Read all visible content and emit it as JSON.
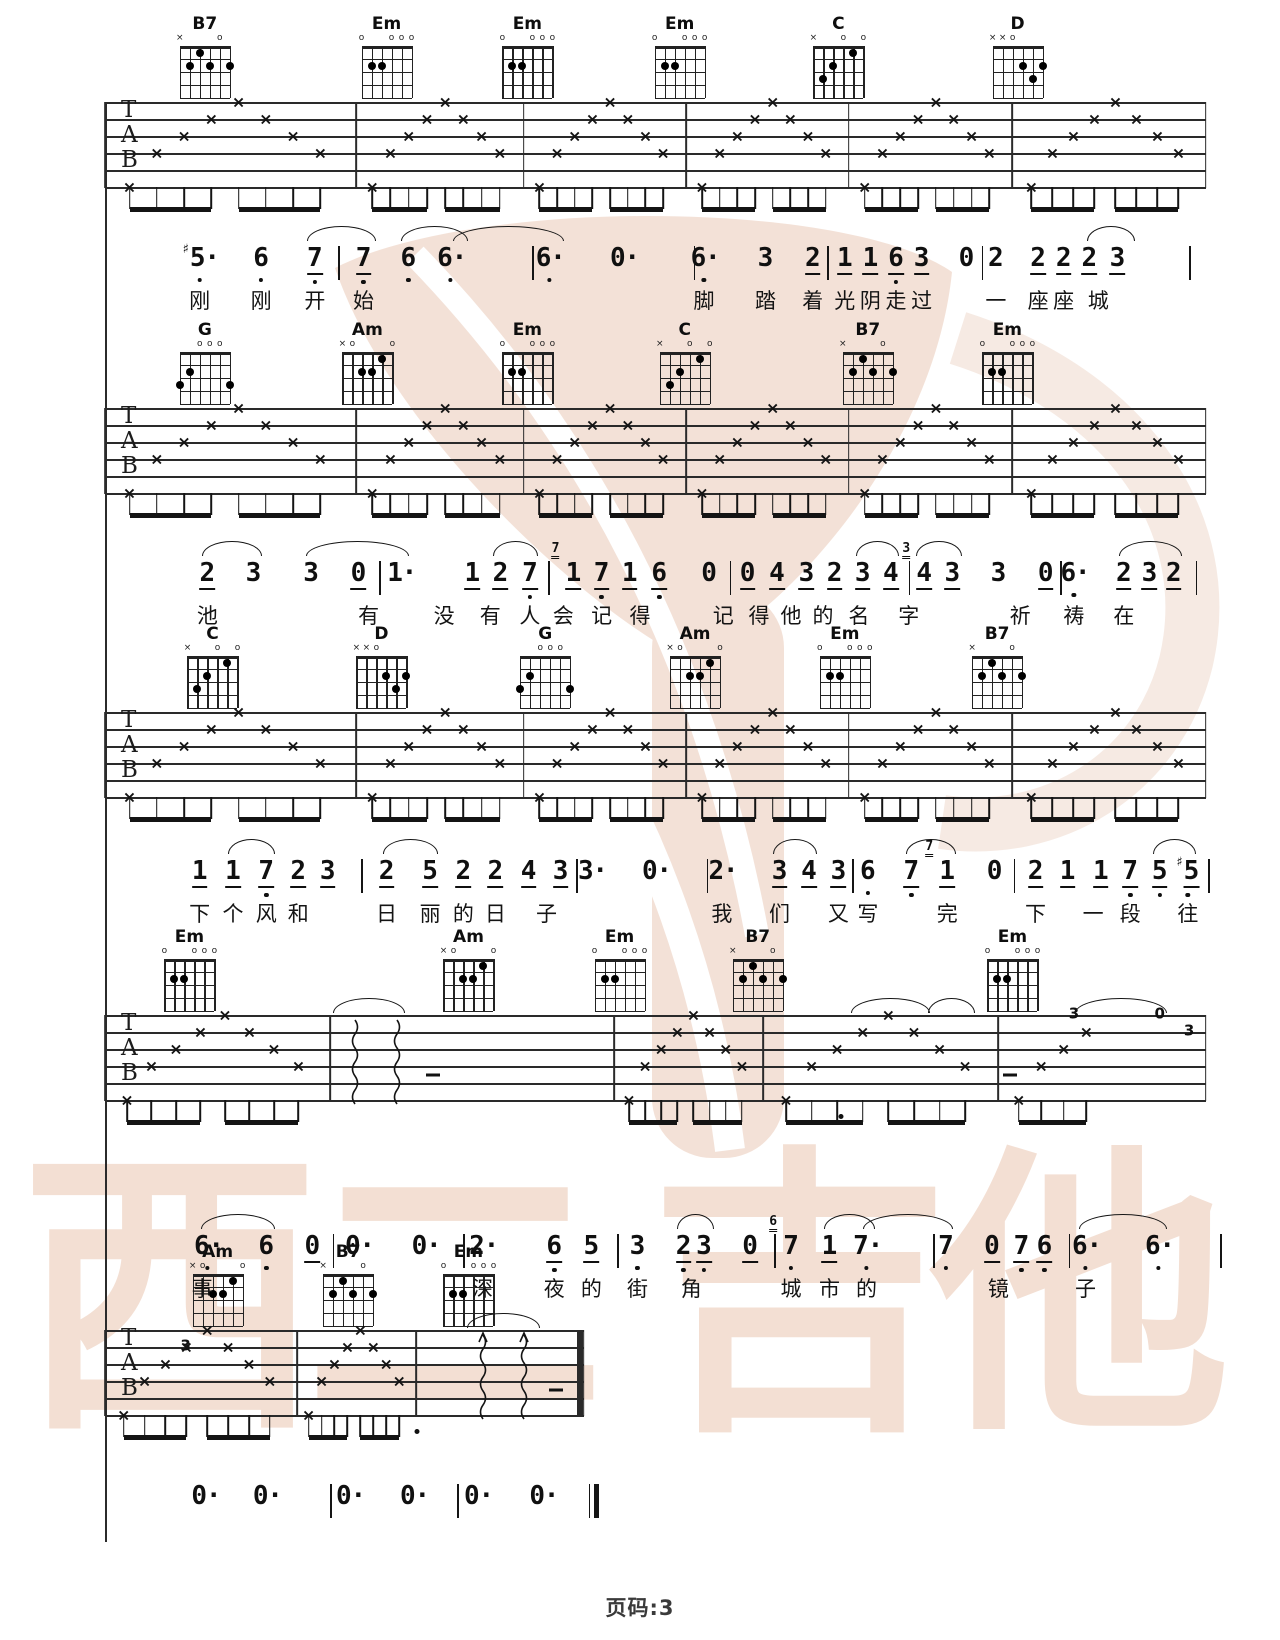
{
  "page": {
    "number_label": "页码:3",
    "paper_color": "#ffffff",
    "ink_color": "#141414"
  },
  "watermark": {
    "chars": [
      "西",
      "二",
      "吉",
      "他"
    ],
    "char_x": [
      170,
      455,
      800,
      1080
    ],
    "text_color": "rgba(224,170,140,0.38)",
    "logo_color": "#e9c5b1",
    "ring_color": "#eed6c8",
    "stripe_color": "#ffffff"
  },
  "strum_pattern": [
    6,
    4,
    3,
    2,
    1,
    2,
    3,
    4
  ],
  "chord_shapes": {
    "B7": {
      "markers": [
        "x",
        "",
        "",
        "",
        "o",
        ""
      ],
      "dots": [
        [
          5,
          2
        ],
        [
          4,
          1
        ],
        [
          3,
          2
        ],
        [
          1,
          2
        ]
      ]
    },
    "Em": {
      "markers": [
        "o",
        "",
        "",
        "o",
        "o",
        "o"
      ],
      "dots": [
        [
          5,
          2
        ],
        [
          4,
          2
        ]
      ]
    },
    "C": {
      "markers": [
        "x",
        "",
        "",
        "o",
        "",
        "o"
      ],
      "dots": [
        [
          5,
          3
        ],
        [
          4,
          2
        ],
        [
          2,
          1
        ]
      ]
    },
    "D": {
      "markers": [
        "x",
        "x",
        "o",
        "",
        "",
        ""
      ],
      "dots": [
        [
          3,
          2
        ],
        [
          2,
          3
        ],
        [
          1,
          2
        ]
      ]
    },
    "G": {
      "markers": [
        "",
        "",
        "o",
        "o",
        "o",
        ""
      ],
      "dots": [
        [
          6,
          3
        ],
        [
          5,
          2
        ],
        [
          1,
          3
        ]
      ]
    },
    "Am": {
      "markers": [
        "x",
        "o",
        "",
        "",
        "",
        "o"
      ],
      "dots": [
        [
          4,
          2
        ],
        [
          3,
          2
        ],
        [
          2,
          1
        ]
      ]
    }
  },
  "systems": [
    {
      "top": 102,
      "left": 8.2,
      "right": 94.2,
      "bars": [
        27.8,
        40.9,
        53.6,
        66.3,
        79.1
      ],
      "chords": [
        [
          "B7",
          16
        ],
        [
          "Em",
          30.2
        ],
        [
          "Em",
          41.2
        ],
        [
          "Em",
          53.1
        ],
        [
          "C",
          65.5
        ],
        [
          "D",
          79.5
        ]
      ]
    },
    {
      "top": 408,
      "left": 8.2,
      "right": 94.2,
      "bars": [
        27.8,
        40.9,
        53.6,
        66.3,
        79.1
      ],
      "chords": [
        [
          "G",
          16
        ],
        [
          "Am",
          28.7
        ],
        [
          "Em",
          41.2
        ],
        [
          "C",
          53.5
        ],
        [
          "B7",
          67.8
        ],
        [
          "Em",
          78.7
        ]
      ]
    },
    {
      "top": 712,
      "left": 8.2,
      "right": 94.2,
      "bars": [
        27.8,
        40.9,
        53.6,
        66.3,
        79.1
      ],
      "chords": [
        [
          "C",
          16.6
        ],
        [
          "D",
          29.8
        ],
        [
          "G",
          42.6
        ],
        [
          "Am",
          54.3
        ],
        [
          "Em",
          66
        ],
        [
          "B7",
          77.9
        ]
      ]
    },
    {
      "top": 1015,
      "left": 8.2,
      "right": 94.2,
      "bars": [
        25.8,
        48,
        59.6,
        78
      ],
      "chords": [
        [
          "Em",
          14.8
        ],
        [
          "Am",
          36.6
        ],
        [
          "Em",
          48.4
        ],
        [
          "B7",
          59.2
        ],
        [
          "Em",
          79.1
        ]
      ],
      "wavy": {
        "measure": 1,
        "xs": [
          27.7,
          31.0
        ],
        "arrow": false
      },
      "dashes": [
        {
          "x": 33.8,
          "line": 3.5
        },
        {
          "x": 78.9,
          "line": 3.5
        }
      ],
      "nums": [
        {
          "t": "3",
          "x": 83.9,
          "line": 1
        },
        {
          "t": "0",
          "x": 90.6,
          "line": 1
        },
        {
          "t": "3",
          "x": 92.9,
          "line": 2
        }
      ],
      "half_measure": 4,
      "dots_below": [
        {
          "x": 65.7
        }
      ],
      "arcs": [
        [
          26,
          31.5
        ],
        [
          66.5,
          72.5
        ],
        [
          72.5,
          76
        ],
        [
          84,
          91
        ]
      ]
    },
    {
      "top": 1330,
      "left": 8.2,
      "right": 45.6,
      "bars": [
        23.2,
        32.5
      ],
      "chords": [
        [
          "Am",
          17
        ],
        [
          "B7",
          27.2
        ],
        [
          "Em",
          36.6
        ]
      ],
      "wavy": {
        "measure": 2,
        "xs": [
          37.7,
          40.9
        ],
        "arrow": true
      },
      "dashes": [
        {
          "x": 43.4,
          "line": 3.5
        }
      ],
      "nums": [
        {
          "t": "3",
          "x": 14.5,
          "line": 2
        }
      ],
      "final": true,
      "dots_below": [
        {
          "x": 32.6
        }
      ],
      "arcs": [
        [
          36.5,
          42
        ]
      ]
    }
  ],
  "flag_legend": "#=sharp d=dot-after l=low-octave-dot u=underline | 4th item = grace note digit",
  "jianpu_lines": [
    {
      "y": 270,
      "tokens": [
        [
          15.6,
          "5",
          "#dl"
        ],
        [
          20.4,
          "6",
          "l"
        ],
        [
          24.6,
          "7",
          "lu"
        ],
        [
          26.4,
          "|"
        ],
        [
          28.4,
          "7",
          "lu"
        ],
        [
          31.9,
          "6",
          "l"
        ],
        [
          35.2,
          "6",
          "dl"
        ],
        [
          41.6,
          "|"
        ],
        [
          42.9,
          "6",
          "dl"
        ],
        [
          48.7,
          "0",
          "d"
        ],
        [
          54.2,
          "|"
        ],
        [
          55,
          "6",
          "dl"
        ],
        [
          59.8,
          "3",
          ""
        ],
        [
          63.5,
          "2",
          "u"
        ],
        [
          64.6,
          "|"
        ],
        [
          66,
          "1",
          "u"
        ],
        [
          68,
          "1",
          "u"
        ],
        [
          70,
          "6",
          "lu"
        ],
        [
          72,
          "3",
          "u"
        ],
        [
          75.5,
          "0",
          ""
        ],
        [
          76.7,
          "|"
        ],
        [
          77.8,
          "2",
          ""
        ],
        [
          81.1,
          "2",
          "u"
        ],
        [
          83.1,
          "2",
          "u"
        ],
        [
          85.1,
          "2",
          "u"
        ],
        [
          87.3,
          "3",
          "u"
        ],
        [
          92.9,
          "|"
        ]
      ],
      "arcs": [
        [
          24,
          29.2
        ],
        [
          31.3,
          36.4
        ],
        [
          35.4,
          43.9
        ],
        [
          84.9,
          88.5
        ]
      ],
      "lyrics": [
        [
          15.6,
          "刚"
        ],
        [
          20.4,
          "刚"
        ],
        [
          24.6,
          "开"
        ],
        [
          28.4,
          "始"
        ],
        [
          55,
          "脚"
        ],
        [
          59.8,
          "踏"
        ],
        [
          63.5,
          "着"
        ],
        [
          66,
          "光"
        ],
        [
          68,
          "阴"
        ],
        [
          70,
          "走"
        ],
        [
          72,
          "过"
        ],
        [
          77.8,
          "一"
        ],
        [
          81.1,
          "座"
        ],
        [
          83.1,
          "座"
        ],
        [
          85.8,
          "城"
        ]
      ]
    },
    {
      "y": 585,
      "tokens": [
        [
          16.2,
          "2",
          "u"
        ],
        [
          19.8,
          "3",
          ""
        ],
        [
          24.3,
          "3",
          ""
        ],
        [
          28,
          "0",
          "u"
        ],
        [
          29.6,
          "|"
        ],
        [
          31.3,
          "1",
          "d"
        ],
        [
          36.9,
          "1",
          "u"
        ],
        [
          39.1,
          "2",
          "u"
        ],
        [
          41.4,
          "7",
          "lu"
        ],
        [
          42.8,
          "|"
        ],
        [
          44.8,
          "1",
          "u",
          "7"
        ],
        [
          47,
          "7",
          "lu"
        ],
        [
          49.2,
          "1",
          "u"
        ],
        [
          51.5,
          "6",
          "lu"
        ],
        [
          55.4,
          "0",
          ""
        ],
        [
          57,
          "|"
        ],
        [
          58.4,
          "0",
          "u"
        ],
        [
          60.7,
          "4",
          "u"
        ],
        [
          63,
          "3",
          "u"
        ],
        [
          65.2,
          "2",
          "u"
        ],
        [
          67.4,
          "3",
          "u"
        ],
        [
          69.6,
          "4",
          "u"
        ],
        [
          71,
          "|"
        ],
        [
          72.2,
          "4",
          "u",
          "3"
        ],
        [
          74.4,
          "3",
          "u"
        ],
        [
          78,
          "3",
          ""
        ],
        [
          81.7,
          "0",
          "u"
        ],
        [
          82.8,
          "|"
        ],
        [
          83.9,
          "6",
          "dl"
        ],
        [
          87.8,
          "2",
          "u"
        ],
        [
          89.8,
          "3",
          "u"
        ],
        [
          91.7,
          "2",
          "u"
        ],
        [
          93.4,
          "|"
        ]
      ],
      "arcs": [
        [
          15.8,
          20.3
        ],
        [
          23.9,
          31.8
        ],
        [
          38.5,
          41.9
        ],
        [
          66.9,
          70.1
        ],
        [
          71.6,
          75
        ],
        [
          87.4,
          92.2
        ]
      ],
      "lyrics": [
        [
          16.2,
          "池"
        ],
        [
          28.8,
          "有"
        ],
        [
          34.7,
          "没"
        ],
        [
          38.3,
          "有"
        ],
        [
          41.4,
          "人"
        ],
        [
          44,
          "会"
        ],
        [
          47,
          "记"
        ],
        [
          50,
          "得"
        ],
        [
          56.5,
          "记"
        ],
        [
          59.3,
          "得"
        ],
        [
          61.8,
          "他"
        ],
        [
          64.3,
          "的"
        ],
        [
          67.1,
          "名"
        ],
        [
          71,
          "字"
        ],
        [
          79.7,
          "祈"
        ],
        [
          83.9,
          "祷"
        ],
        [
          87.8,
          "在"
        ]
      ]
    },
    {
      "y": 883,
      "tokens": [
        [
          15.6,
          "1",
          "u"
        ],
        [
          18.2,
          "1",
          "u"
        ],
        [
          20.8,
          "7",
          "lu"
        ],
        [
          23.3,
          "2",
          "u"
        ],
        [
          25.6,
          "3",
          "u"
        ],
        [
          28.2,
          "|"
        ],
        [
          30.2,
          "2",
          "u"
        ],
        [
          33.6,
          "5",
          "u"
        ],
        [
          36.2,
          "2",
          "u"
        ],
        [
          38.7,
          "2",
          "u"
        ],
        [
          41.3,
          "4",
          "u"
        ],
        [
          43.8,
          "3",
          "u"
        ],
        [
          45,
          "|"
        ],
        [
          46.2,
          "3",
          "d"
        ],
        [
          51.2,
          "0",
          "d"
        ],
        [
          55.2,
          "|"
        ],
        [
          56.4,
          "2",
          "d"
        ],
        [
          60.9,
          "3",
          "u"
        ],
        [
          63.2,
          "4",
          "u"
        ],
        [
          65.5,
          "3",
          "u"
        ],
        [
          66.6,
          "|"
        ],
        [
          67.8,
          "6",
          "l"
        ],
        [
          71.2,
          "7",
          "lu"
        ],
        [
          74,
          "1",
          "u",
          "7"
        ],
        [
          77.7,
          "0",
          ""
        ],
        [
          79.2,
          "|"
        ],
        [
          80.9,
          "2",
          "u"
        ],
        [
          83.4,
          "1",
          "u"
        ],
        [
          86,
          "1",
          "u"
        ],
        [
          88.3,
          "7",
          "lu"
        ],
        [
          90.6,
          "5",
          "lu"
        ],
        [
          92.8,
          "5",
          "#lu"
        ],
        [
          94.4,
          "|"
        ]
      ],
      "arcs": [
        [
          17.8,
          21.3
        ],
        [
          29.9,
          34.1
        ],
        [
          60.4,
          63.7
        ],
        [
          70.8,
          74.5
        ],
        [
          90.1,
          93.3
        ]
      ],
      "lyrics": [
        [
          15.6,
          "下"
        ],
        [
          18.2,
          "个"
        ],
        [
          20.8,
          "风"
        ],
        [
          23.3,
          "和"
        ],
        [
          30.2,
          "日"
        ],
        [
          33.6,
          "丽"
        ],
        [
          36.2,
          "的"
        ],
        [
          38.7,
          "日"
        ],
        [
          42.7,
          "子"
        ],
        [
          56.4,
          "我"
        ],
        [
          60.9,
          "们"
        ],
        [
          65.5,
          "又"
        ],
        [
          67.8,
          "写"
        ],
        [
          74,
          "完"
        ],
        [
          80.9,
          "下"
        ],
        [
          85.4,
          "一"
        ],
        [
          88.3,
          "段"
        ],
        [
          92.8,
          "往"
        ]
      ]
    },
    {
      "y": 1258,
      "tokens": [
        [
          16.2,
          "6",
          "dl"
        ],
        [
          20.8,
          "6",
          "l"
        ],
        [
          24.4,
          "0",
          "u"
        ],
        [
          26,
          "|"
        ],
        [
          28,
          "0",
          "d"
        ],
        [
          33.2,
          "0",
          "d"
        ],
        [
          36.2,
          "|"
        ],
        [
          37.7,
          "2",
          "d"
        ],
        [
          43.3,
          "6",
          "lu"
        ],
        [
          46.2,
          "5",
          "u"
        ],
        [
          48.2,
          "|"
        ],
        [
          49.8,
          "3",
          "l"
        ],
        [
          53.4,
          "2",
          "lu"
        ],
        [
          55,
          "3",
          "lu"
        ],
        [
          58.6,
          "0",
          "u"
        ],
        [
          60.5,
          "|"
        ],
        [
          61.8,
          "7",
          "l",
          "6"
        ],
        [
          64.8,
          "1",
          "u"
        ],
        [
          67.7,
          "7",
          "dl"
        ],
        [
          72.9,
          "|"
        ],
        [
          73.9,
          "7",
          "l"
        ],
        [
          77.5,
          "0",
          "u"
        ],
        [
          79.8,
          "7",
          "lu"
        ],
        [
          81.6,
          "6",
          "lu"
        ],
        [
          83.5,
          "|"
        ],
        [
          84.8,
          "6",
          "dl"
        ],
        [
          90.5,
          "6",
          "dl"
        ],
        [
          95.3,
          "|"
        ]
      ],
      "arcs": [
        [
          15.7,
          21.3
        ],
        [
          52.9,
          55.6
        ],
        [
          64.4,
          68.2
        ],
        [
          67.4,
          74.3
        ],
        [
          84.3,
          91
        ]
      ],
      "lyrics": [
        [
          15.8,
          "事"
        ],
        [
          37.7,
          "深"
        ],
        [
          43.3,
          "夜"
        ],
        [
          46.2,
          "的"
        ],
        [
          49.8,
          "街"
        ],
        [
          54,
          "角"
        ],
        [
          61.8,
          "城"
        ],
        [
          64.8,
          "市"
        ],
        [
          67.7,
          "的"
        ],
        [
          78,
          "镜"
        ],
        [
          84.8,
          "子"
        ]
      ]
    },
    {
      "y": 1508,
      "tokens": [
        [
          16,
          "0",
          "d"
        ],
        [
          20.8,
          "0",
          "d"
        ],
        [
          25.8,
          "|"
        ],
        [
          27.3,
          "0",
          "d"
        ],
        [
          32.3,
          "0",
          "d"
        ],
        [
          35.7,
          "|"
        ],
        [
          37.3,
          "0",
          "d"
        ],
        [
          42.4,
          "0",
          "d"
        ],
        [
          46,
          "||"
        ]
      ],
      "arcs": [],
      "lyrics": []
    }
  ]
}
